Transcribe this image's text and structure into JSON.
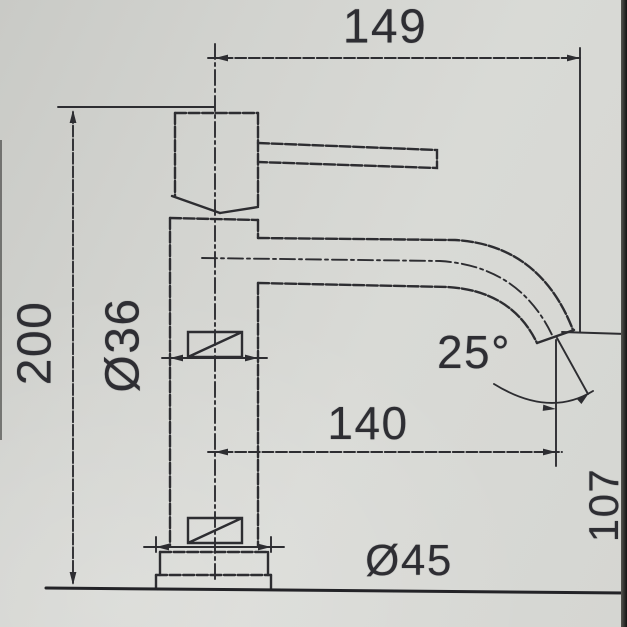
{
  "drawing": {
    "type": "technical-drawing",
    "subject": "basin mixer tap - side elevation",
    "paper_color": "#d3d4d0",
    "line_color": "#2d2d31",
    "photo_edge_color": "#121212",
    "dimensions": {
      "height": "200",
      "reach_overall": "149",
      "reach_to_outlet": "140",
      "spout_angle": "25°",
      "outlet_height": "107",
      "body_diameter": "Ø36",
      "base_diameter": "Ø45"
    }
  }
}
